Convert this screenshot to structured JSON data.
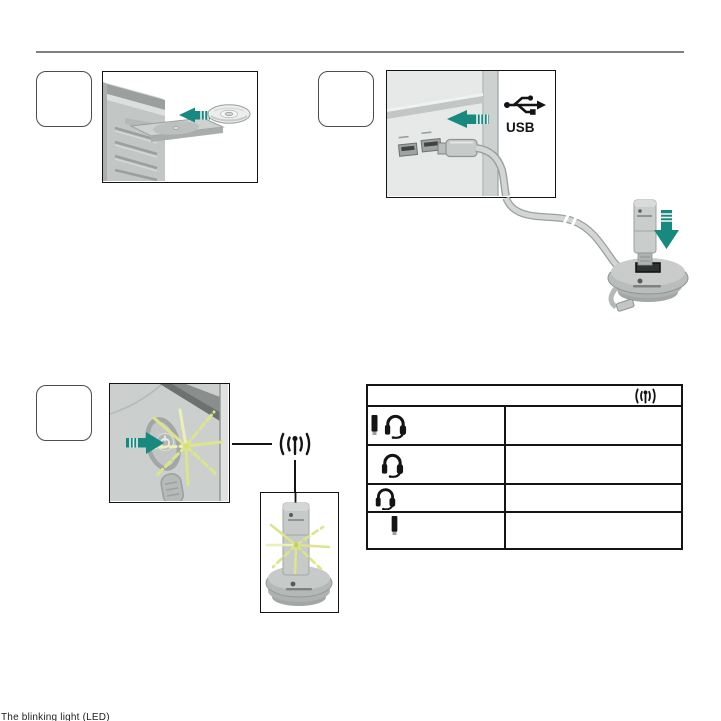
{
  "document": {
    "kind": "headset-quick-start-page",
    "divider_color": "#7f7f7f"
  },
  "colors": {
    "arrow_teal": "#17897e",
    "blink_yellow": "#dde48c",
    "line_black": "#141414",
    "illustration_gray": "#c6cac8"
  },
  "steps": [
    {
      "label": "",
      "illustration": "insert-cd-into-computer"
    },
    {
      "label": "",
      "illustration": "connect-usb-cable-and-receiver-base"
    },
    {
      "label": "",
      "illustration": "press-power-button-status-light-blinks"
    }
  ],
  "usb": {
    "label": "USB"
  },
  "wireless": {
    "icon": "wireless-signal-icon"
  },
  "status_table": {
    "header_icon": "wireless-signal-icon",
    "rows": [
      {
        "icons": [
          "usb-receiver-icon",
          "headset-icon"
        ],
        "text": ""
      },
      {
        "icons": [
          "headset-icon"
        ],
        "text": ""
      },
      {
        "icons": [
          "headset-icon"
        ],
        "text": ""
      },
      {
        "icons": [
          "usb-receiver-icon"
        ],
        "text": ""
      }
    ]
  },
  "caption": "The blinking light (LED)"
}
